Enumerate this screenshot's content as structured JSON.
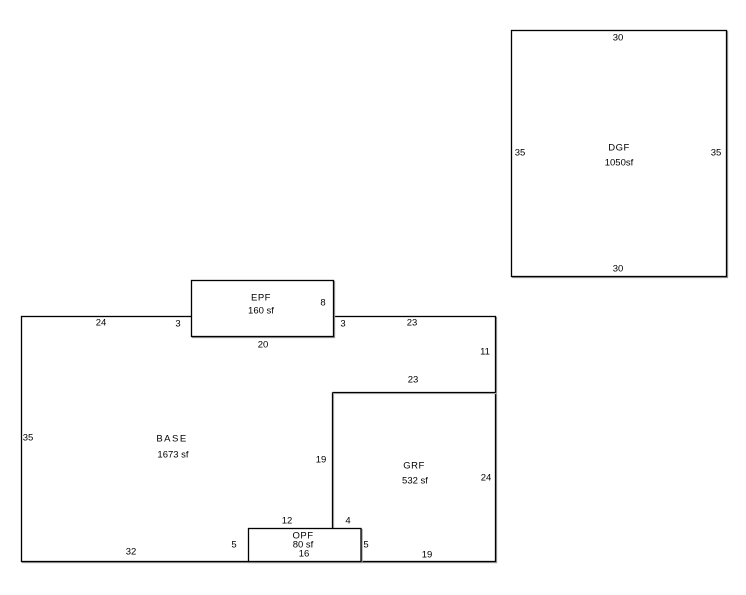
{
  "colors": {
    "background": "#ffffff",
    "line": "#000000",
    "shadow": "#9b9b9b",
    "text": "#000000"
  },
  "shapes": {
    "dgf": {
      "label": "DGF",
      "area": "1050sf",
      "dims": {
        "top": "30",
        "bottom": "30",
        "left": "35",
        "right": "35"
      }
    },
    "epf": {
      "label": "EPF",
      "area": "160 sf",
      "dims": {
        "inner_right": "8",
        "stub_left": "3",
        "stub_right": "3",
        "bottom": "20"
      }
    },
    "base": {
      "label": "BASE",
      "area": "1673 sf",
      "dims": {
        "top_left": "24",
        "top_right": "23",
        "right": "11",
        "left": "35",
        "bottom": "32"
      }
    },
    "grf": {
      "label": "GRF",
      "area": "532 sf",
      "dims": {
        "top": "23",
        "left": "19",
        "right": "24",
        "bottom": "19"
      }
    },
    "opf": {
      "label": "OPF",
      "area": "80 sf",
      "dims": {
        "top_left": "12",
        "top_right": "4",
        "left": "5",
        "right": "5",
        "width": "16"
      }
    }
  }
}
